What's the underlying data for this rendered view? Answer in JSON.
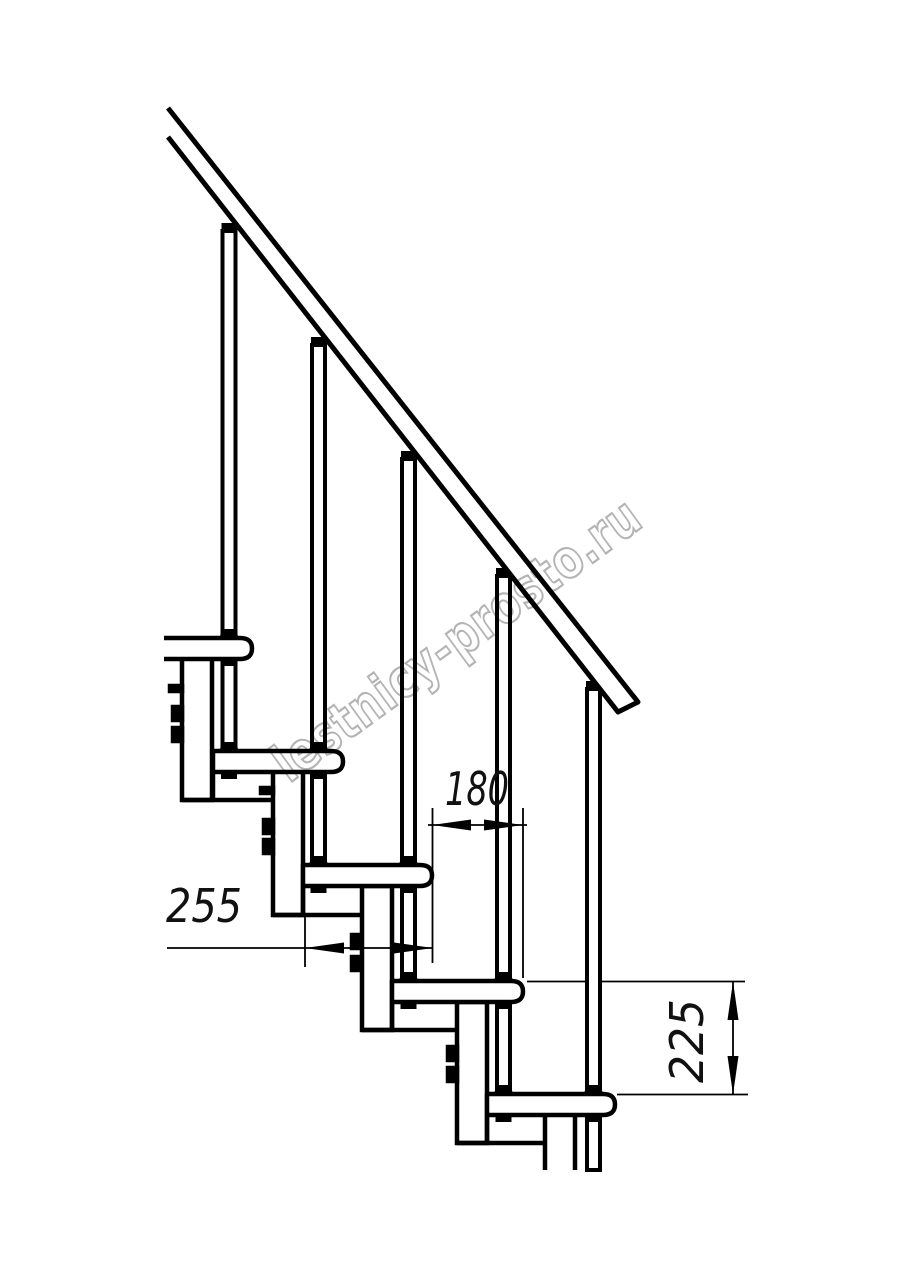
{
  "drawing": {
    "title": "staircase-module-side-view",
    "watermark_text": "lestnicy-prosto.ru",
    "dimensions": {
      "tread_depth_label": "255",
      "step_run_label": "180",
      "riser_height_label": "225"
    },
    "colors": {
      "line": "#000000",
      "background": "#ffffff",
      "watermark": "#b4b4b4"
    }
  }
}
